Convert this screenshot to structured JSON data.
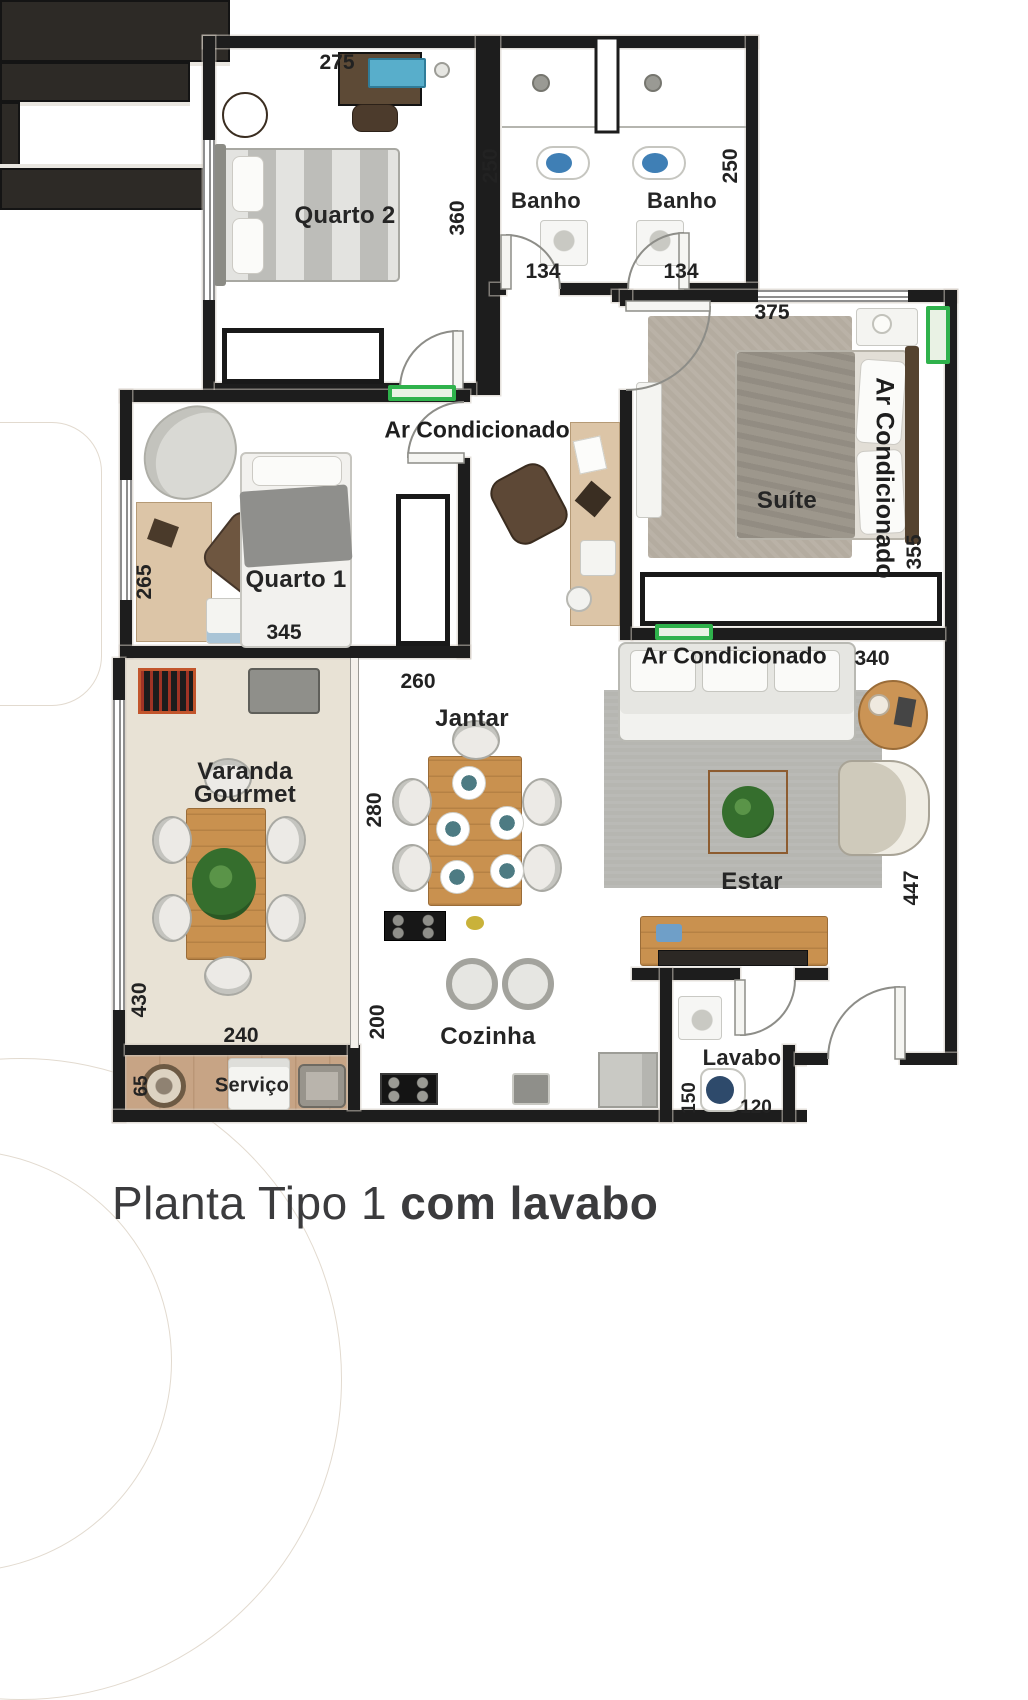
{
  "title": {
    "regular": "Planta Tipo 1",
    "bold": " com lavabo"
  },
  "colors": {
    "wall": "#1d1d1d",
    "ac_green": "#2fb24c",
    "wood_floor": "#d8b183",
    "tile_floor": "#ece7dc"
  },
  "rooms": {
    "quarto2": {
      "label": "Quarto 2",
      "dim_width": "275",
      "dim_height": "360"
    },
    "banho_left": {
      "label": "Banho",
      "dim_height": "250",
      "dim_width": "134"
    },
    "banho_right": {
      "label": "Banho",
      "dim_height": "250",
      "dim_width": "134"
    },
    "suite": {
      "label": "Suíte",
      "dim_width": "375",
      "dim_height": "355",
      "ac_label": "Ar Condicionado"
    },
    "quarto1": {
      "label": "Quarto 1",
      "dim_height": "265",
      "dim_width": "345"
    },
    "hall": {
      "ac_label": "Ar Condicionado",
      "dim_counter": "260"
    },
    "varanda": {
      "label_line1": "Varanda",
      "label_line2": "Gourmet",
      "dim_height": "430",
      "dim_width": "240"
    },
    "jantar": {
      "label": "Jantar",
      "dim_width": "280"
    },
    "cozinha": {
      "label": "Cozinha",
      "dim_height": "200",
      "dim_counter": "320"
    },
    "estar": {
      "label": "Estar",
      "ac_label": "Ar Condicionado",
      "dim_width": "340",
      "dim_height": "447"
    },
    "servico": {
      "label": "Serviço",
      "dim_height": "65"
    },
    "lavabo": {
      "label": "Lavabo",
      "dim_height": "150",
      "dim_width": "120"
    }
  }
}
